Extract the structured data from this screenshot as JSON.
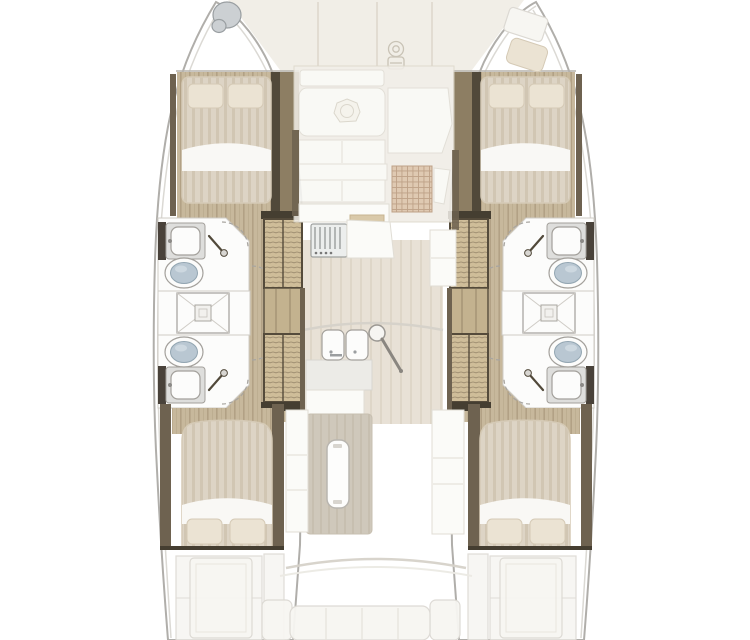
{
  "canvas": {
    "width": 750,
    "height": 640,
    "background": "#ffffff"
  },
  "colors": {
    "canvas-bg": "#ffffff",
    "hull-fill": "#ffffff",
    "hull-stroke": "#b0aeaa",
    "hull-inner-line": "#dbd9d4",
    "deck-fill": "#f1eee7",
    "deck-line": "#dcd7ca",
    "salon-fill": "#f2efe9",
    "wood-base": "#c7b89c",
    "wood-stripe": "#b2a185",
    "trim-dark": "#6e6250",
    "trim-wood": "#8d7e63",
    "trim-edge": "#51493a",
    "dark-cap": "#453e31",
    "stair-base": "#cfbd99",
    "stair-wave": "#97866a",
    "stair-frame": "#554b3b",
    "landing": "#c3b28f",
    "duvet-base": "#ddd4c5",
    "duvet-stripe": "#d1c6b3",
    "sheet": "#f9f8f5",
    "pillow": "#ebe3d3",
    "pillow-stroke": "#d5cab6",
    "room-white": "#fcfcfb",
    "room-stroke": "#cfccc6",
    "fixture-stroke": "#a3a09b",
    "sink-frame": "#dededc",
    "backsplash-dark": "#49423a",
    "toilet-lid": "#b9c7d2",
    "toilet-lid-stroke": "#92a5b1",
    "dash": "#a8a5a0",
    "white-furn": "#fbfbf8",
    "furn-stroke": "#e0ddd5",
    "corr-base": "#e8e1d6",
    "corr-stripe": "#ded6c8",
    "arc-line": "#d6d2ca",
    "grid-base": "#dcc3a9",
    "grid-line": "#b69478",
    "rug-base": "#cfc8bb",
    "rug-stripe": "#c7bfb0",
    "counter-tan": "#d9c9a9",
    "stove-frame": "#9fa2a0",
    "stove-line": "#8e9290",
    "metal": "#ccd0d3",
    "metal-stroke": "#999ea1",
    "faded-white": "#f7f6f2",
    "faded-stroke": "#dcd9d3"
  },
  "floorplan": {
    "vessel_type": "catamaran",
    "view": "top-down deck plan",
    "hulls": [
      {
        "side": "port",
        "forward_cabin": {
          "bed": "double",
          "pillows": 2
        },
        "aft_cabin": {
          "bed": "double",
          "pillows": 2
        },
        "bathrooms": [
          {
            "position": "forward",
            "fixtures": [
              "sink",
              "toilet",
              "shower-wand"
            ]
          },
          {
            "position": "aft",
            "fixtures": [
              "sink",
              "toilet",
              "shower-wand"
            ]
          }
        ],
        "shared_shower_stalls": 1,
        "companionway_stair_flights": 2,
        "bow_fitting": "capstan-circles"
      },
      {
        "side": "starboard",
        "forward_cabin": {
          "bed": "double",
          "pillows": 2
        },
        "aft_cabin": {
          "bed": "double",
          "pillows": 2
        },
        "bathrooms": [
          {
            "position": "forward",
            "fixtures": [
              "sink",
              "toilet",
              "shower-wand"
            ]
          },
          {
            "position": "aft",
            "fixtures": [
              "sink",
              "toilet",
              "shower-wand"
            ]
          }
        ],
        "shared_shower_stalls": 1,
        "companionway_stair_flights": 2,
        "bow_fitting": "forepeak berth cushion and hatch panel"
      }
    ],
    "center_deck": {
      "foredeck": {
        "windlass": 1,
        "panel_lines": 3
      },
      "salon": {
        "table": 1,
        "bowl_on_table": 1,
        "bench_rows": 3,
        "side_seat": 1,
        "grid_mat": 1
      },
      "galley": {
        "stove": 1,
        "burner_grate_lines": 6,
        "double_sink": 1,
        "counters": 2,
        "support_pole": 1,
        "cabinet_column": 1
      },
      "dinette": {
        "table": 1,
        "rug": 1,
        "side_cabinets": 2
      },
      "cockpit": {
        "bench": 1,
        "bench_seams": 3,
        "armrests": 2,
        "side_tables": 2,
        "door_arc": 1
      }
    }
  },
  "icons": {
    "windlass-icon": "small circle above rounded box outline on foredeck",
    "capstan-icon": "two overlapping grey circles at port bow tip",
    "shower-wand-icon": "diagonal wand line with round head",
    "door-swing-icon": "dashed quarter-circle arc",
    "shower-drain-icon": "square shower pan with X and nested center square",
    "bowl-icon": "heptagon with inner circle on salon table"
  }
}
